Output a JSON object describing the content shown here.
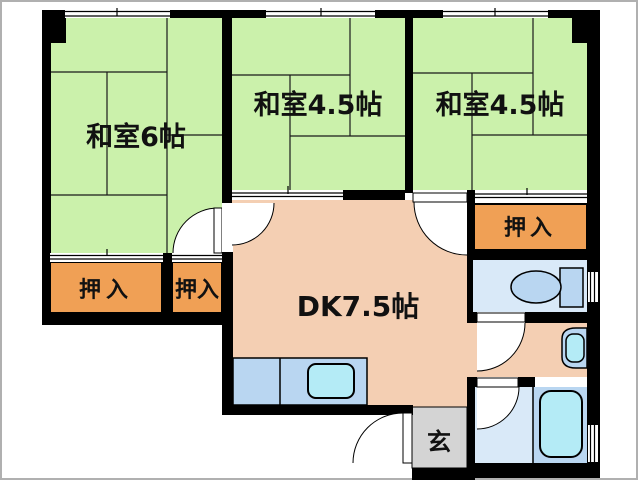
{
  "plan": {
    "type": "apartment-floor-plan",
    "labels": {
      "room1": "和室6帖",
      "room2": "和室4.5帖",
      "room3": "和室4.5帖",
      "closet1": "押入",
      "closet2": "押入",
      "closet3": "押入",
      "dk": "DK7.5帖",
      "entrance": "玄"
    },
    "colors": {
      "wall": "#000000",
      "tatami_green": "#cbf1ab",
      "closet_orange": "#f0a055",
      "dk_peach": "#f4cfb3",
      "entrance_gray": "#d4d4d4",
      "wet_floor_blue": "#d9e9f8",
      "fixture_blue": "#b9d6f1",
      "basin_cyan": "#b4ebf6",
      "frame_gray": "#b0b0b0",
      "white": "#ffffff"
    }
  }
}
